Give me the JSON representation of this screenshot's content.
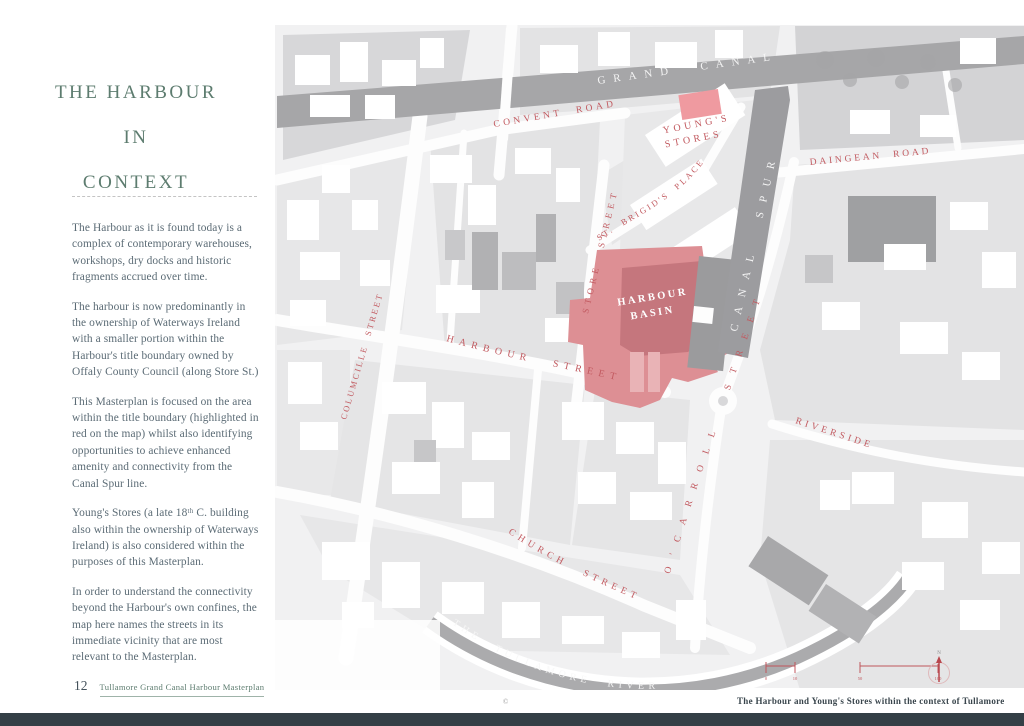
{
  "page": {
    "number": "12",
    "footer_title": "Tullamore Grand Canal Harbour Masterplan",
    "copyright": "©"
  },
  "sidebar": {
    "title_lines": [
      "THE HARBOUR",
      "IN",
      "CONTEXT"
    ],
    "paragraphs": [
      "The Harbour as it is found today is a complex of contemporary warehouses, workshops, dry docks and historic fragments accrued over time.",
      "The harbour is now predominantly in the ownership of Waterways Ireland with a smaller portion within the Harbour's title boundary owned by Offaly County Council (along Store St.)",
      "This Masterplan is focused on the area within the title boundary (highlighted in red on the map) whilst also identifying opportunities to achieve enhanced amenity and connectivity from the Canal Spur line.",
      "Young's Stores (a late 18ᵗʰ C. building also within the ownership of Waterways Ireland) is also considered within the purposes of this Masterplan.",
      "In order to understand the connectivity beyond the Harbour's own confines, the map here names the streets in its immediate vicinity that are most relevant to the Masterplan."
    ]
  },
  "map": {
    "labels": {
      "grand_canal": "GRAND CANAL",
      "convent_road": "CONVENT ROAD",
      "youngs_stores_line1": "YOUNG'S",
      "youngs_stores_line2": "STORES",
      "daingean_road": "DAINGEAN ROAD",
      "canal_spur": "CANAL SPUR",
      "st_brigids_place": "ST. BRIGID'S PLACE",
      "store_street": "STORE STREET",
      "harbour_basin_line1": "HARBOUR",
      "harbour_basin_line2": "BASIN",
      "ocarroll_street": "O'CARROLL STREET",
      "harbour_street": "HARBOUR STREET",
      "columcille_street": "COLUMCILLE STREET",
      "church_street": "CHURCH STREET",
      "riverside": "RIVERSIDE",
      "tullamore_river": "THE TULLAMORE RIVER"
    },
    "caption": "The Harbour and Young's Stores within the context of Tullamore",
    "scale": {
      "labels": [
        "0",
        "10",
        "50",
        "100"
      ],
      "north": "N"
    },
    "colors": {
      "highlight": "#dd8f94",
      "highlight_dark": "#c5767d",
      "youngs_pink": "#ef9aa0",
      "label_red": "#c25a60",
      "title_green": "#5d7c6f",
      "canal_grey": "#a6a6a8"
    }
  }
}
